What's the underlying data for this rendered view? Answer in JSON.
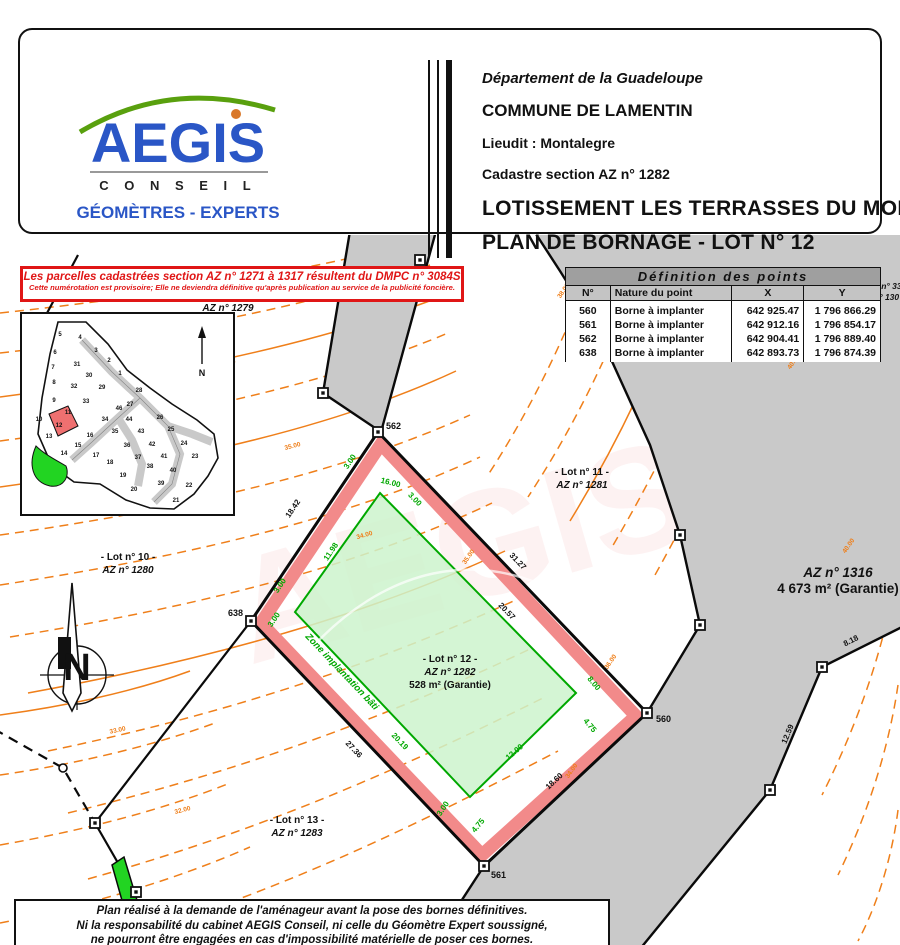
{
  "header": {
    "logo": {
      "name": "AEGIS",
      "conseil": "C O N S E I L",
      "tagline": "GÉOMÈTRES - EXPERTS"
    },
    "department": "Département de la Guadeloupe",
    "commune": "COMMUNE DE LAMENTIN",
    "lieudit": "Lieudit : Montalegre",
    "cadastre": "Cadastre section AZ n° 1282",
    "title_line1": "LOTISSEMENT LES TERRASSES DU MONT",
    "title_line2": "PLAN DE BORNAGE - LOT N° 12"
  },
  "notice": {
    "line1": "Les parcelles cadastrées section AZ n° 1271 à 1317 résultent du DMPC n° 3084S",
    "line2": "Cette numérotation est provisoire; Elle ne deviendra définitive qu'après publication au service de la publicité foncière."
  },
  "points_table": {
    "title": "Définition des points",
    "headers": [
      "N°",
      "Nature du point",
      "X",
      "Y"
    ],
    "rows": [
      [
        "560",
        "Borne à implanter",
        "642 925.47",
        "1 796 866.29"
      ],
      [
        "561",
        "Borne à implanter",
        "642 912.16",
        "1 796 854.17"
      ],
      [
        "562",
        "Borne à implanter",
        "642 904.41",
        "1 796 889.40"
      ],
      [
        "638",
        "Borne à implanter",
        "642 893.73",
        "1 796 874.39"
      ]
    ]
  },
  "inset": {
    "numbers": [
      "5",
      "4",
      "3",
      "2",
      "1",
      "6",
      "7",
      "8",
      "9",
      "10",
      "31",
      "30",
      "32",
      "29",
      "33",
      "28",
      "27",
      "46",
      "26",
      "11",
      "12",
      "34",
      "44",
      "25",
      "13",
      "35",
      "43",
      "24",
      "16",
      "15",
      "36",
      "42",
      "23",
      "14",
      "17",
      "37",
      "41",
      "18",
      "38",
      "40",
      "19",
      "22",
      "39",
      "20",
      "21"
    ],
    "north": "N"
  },
  "compass": {
    "n": "N"
  },
  "map": {
    "lots": {
      "lot9_l1": "- Lot n° 9 -",
      "lot9_l2": "AZ n° 1279",
      "lot10_l1": "- Lot n° 10 -",
      "lot10_l2": "AZ n° 1280",
      "lot11_l1": "- Lot n° 11 -",
      "lot11_l2": "AZ n° 1281",
      "lot12_l1": "- Lot n° 12 -",
      "lot12_l2": "AZ n° 1282",
      "lot12_l3": "528 m² (Garantie)",
      "lot13_l1": "- Lot n° 13 -",
      "lot13_l2": "AZ n° 1283",
      "az1316_l1": "AZ n° 1316",
      "az1316_l2": "4 673 m² (Garantie)",
      "partial_l1": "t n° 33",
      "partial_l2": "n° 130"
    },
    "zone_label": "Zone implantation bâti",
    "points": {
      "p560": "560",
      "p561": "561",
      "p562": "562",
      "p638": "638"
    },
    "dims": {
      "d1842": "18.42",
      "d3127": "31.27",
      "d2057": "20.57",
      "d2736": "27.36",
      "d1860": "18.60",
      "d818": "8.18",
      "d1259": "12.59",
      "d2019": "20.19",
      "d300": "3.00",
      "d1600": "16.00",
      "d1198": "11.98",
      "d800": "8.00",
      "d475": "4.75",
      "d1200": "12.00"
    },
    "contours": {
      "c32": "32.00",
      "c33": "33.00",
      "c34": "34.00",
      "c35": "35.00",
      "c36": "36.00",
      "c37": "37.00",
      "c38": "38.00",
      "c40": "40.00",
      "c41": "41.00"
    }
  },
  "footer": {
    "line1": "Plan réalisé à la demande de l'aménageur avant la pose des bornes définitives.",
    "line2": "Ni la responsabilité du cabinet AEGIS Conseil, ni celle du Géomètre Expert soussigné,",
    "line3": "ne pourront être engagées en cas d'impossibilité matérielle de poser ces bornes."
  },
  "colors": {
    "logo_blue": "#2a56c6",
    "logo_green": "#59a00e",
    "alert_red": "#e01616",
    "contour_orange": "#ef7f1a",
    "parcel_pink": "#f28a8a",
    "zone_green_line": "#00a800",
    "zone_green_fill": "#cdf3cd",
    "road_gray": "#c9c9c9",
    "highlight_green": "#22d422",
    "lot12_red": "#ef7070"
  }
}
